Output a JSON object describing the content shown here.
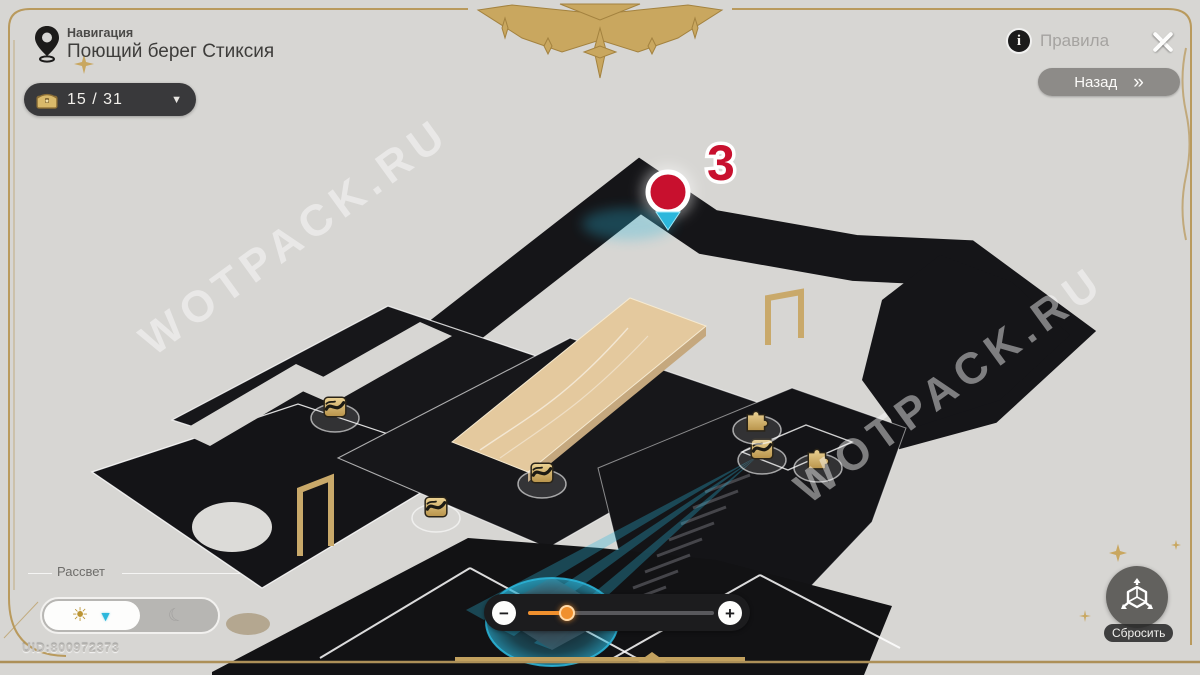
{
  "header": {
    "nav_label": "Навигация",
    "location_title": "Поющий берег Стиксия",
    "chest_counter": "15 / 31",
    "dropdown_glyph": "▼",
    "rules_label": "Правила",
    "info_glyph": "i",
    "back_label": "Назад",
    "back_chevrons": "»"
  },
  "map": {
    "marker_number": "3",
    "watermark": "WOTPACK.RU",
    "icons": [
      {
        "type": "chest",
        "x": 335,
        "y": 408
      },
      {
        "type": "chest",
        "x": 436,
        "y": 508
      },
      {
        "type": "chest",
        "x": 542,
        "y": 474
      },
      {
        "type": "chest",
        "x": 762,
        "y": 450
      },
      {
        "type": "puzzle",
        "x": 757,
        "y": 420
      },
      {
        "type": "puzzle",
        "x": 818,
        "y": 458
      }
    ]
  },
  "controls": {
    "time_label": "Рассвет",
    "sun_glyph": "☀",
    "day_arrow_glyph": "▼",
    "moon_glyph": "☾",
    "zoom_minus": "−",
    "zoom_plus": "+",
    "zoom_percent": 21,
    "reset_label": "Сбросить"
  },
  "footer": {
    "uid": "UID:800972373"
  },
  "colors": {
    "accent_gold": "#c2a15f",
    "marker_red": "#c8102e",
    "cyan": "#2bb7dc",
    "platform_dark": "#17171a",
    "bridge_tan": "#e4c99e"
  }
}
